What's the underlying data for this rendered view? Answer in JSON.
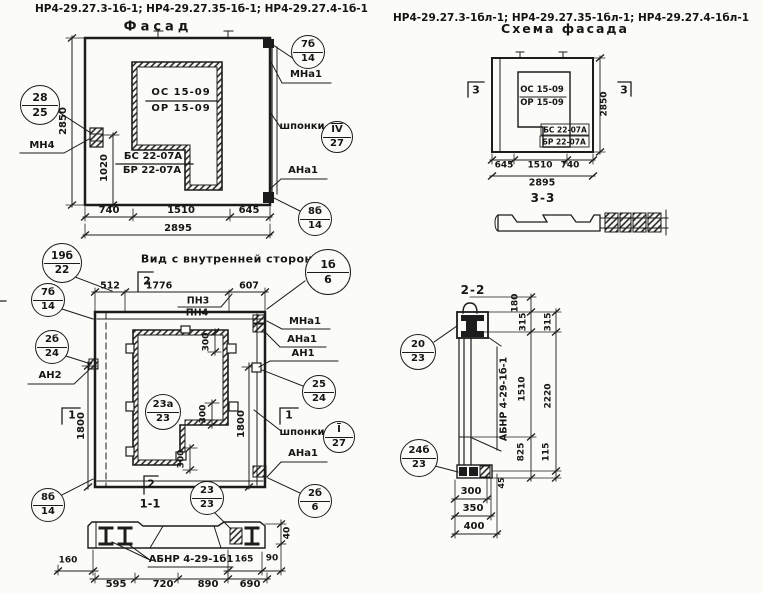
{
  "headers": {
    "left": "НР4-29.27.3-1б-1; НР4-29.27.35-1б-1; НР4-29.27.4-1б-1",
    "right": "НР4-29.27.3-1бл-1; НР4-29.27.35-1бл-1; НР4-29.27.4-1бл-1"
  },
  "facade": {
    "title": "Фасад",
    "window_top": "ОС 15-09",
    "window_bottom": "ОР 15-09",
    "sill_top": "БС 22-07А",
    "sill_bottom": "БР 22-07А",
    "label_mn4": "МН4",
    "label_mna1": "МНа1",
    "label_shponki": "шпонки",
    "label_ana1": "АНа1",
    "dim_height": "2850",
    "dim_1020": "1020",
    "dim_740": "740",
    "dim_1510": "1510",
    "dim_645": "645",
    "dim_total": "2895",
    "co_left": {
      "top": "28",
      "bottom": "25"
    },
    "co_top_right": {
      "top": "7б",
      "bottom": "14"
    },
    "co_shponki": {
      "top": "IV",
      "bottom": "27"
    },
    "co_bottom_right": {
      "top": "8б",
      "bottom": "14"
    }
  },
  "schema": {
    "title": "Схема фасада",
    "window_top": "ОС 15-09",
    "window_bottom": "ОР 15-09",
    "sill_top": "БС 22-07А",
    "sill_bottom": "БР 22-07А",
    "marker": "3",
    "dim_height": "2850",
    "dim_645": "645",
    "dim_1510": "1510",
    "dim_740": "740",
    "dim_total": "2895",
    "section_label": "3-3"
  },
  "inner": {
    "title": "Вид с внутренней стороны",
    "dim_512": "512",
    "dim_1776": "1776",
    "dim_607": "607",
    "label_pn3": "ПН3",
    "label_pn4": "ПН4",
    "label_mna1": "МНа1",
    "label_ana1": "АНа1",
    "label_an1": "АН1",
    "label_an2": "АН2",
    "label_shponki": "шпонки",
    "label_ana1_b": "АНа1",
    "dim_1800": "1800",
    "dim_300": "300",
    "marker_1": "1",
    "marker_2": "2",
    "section_label": "1-1",
    "co_19b": {
      "top": "19б",
      "bottom": "22"
    },
    "co_1b": {
      "top": "1б",
      "bottom": "6"
    },
    "co_7b": {
      "top": "7б",
      "bottom": "14"
    },
    "co_2b24": {
      "top": "2б",
      "bottom": "24"
    },
    "co_8b": {
      "top": "8б",
      "bottom": "14"
    },
    "co_23a": {
      "top": "23а",
      "bottom": "23"
    },
    "co_25": {
      "top": "25",
      "bottom": "24"
    },
    "co_i27": {
      "top": "I",
      "bottom": "27"
    },
    "co_2b6": {
      "top": "2б",
      "bottom": "6"
    },
    "co_23": {
      "top": "23",
      "bottom": "23"
    }
  },
  "sec11": {
    "label": "АБНР 4-29-1б1",
    "dim_160": "160",
    "dim_165": "165",
    "dim_90": "90",
    "dim_40": "40",
    "dim_595": "595",
    "dim_720": "720",
    "dim_890": "890",
    "dim_690": "690"
  },
  "sec22": {
    "title": "2-2",
    "label": "АБНР 4-29-1б-1",
    "co_20": {
      "top": "20",
      "bottom": "23"
    },
    "co_24b": {
      "top": "24б",
      "bottom": "23"
    },
    "dim_180": "180",
    "dim_315": "315",
    "dim_1510": "1510",
    "dim_825": "825",
    "dim_2220": "2220",
    "dim_115": "115",
    "dim_45": "45",
    "dim_300": "300",
    "dim_350": "350",
    "dim_400": "400"
  },
  "colors": {
    "ink": "#1c1c1c",
    "paper": "#fbfbf8"
  }
}
